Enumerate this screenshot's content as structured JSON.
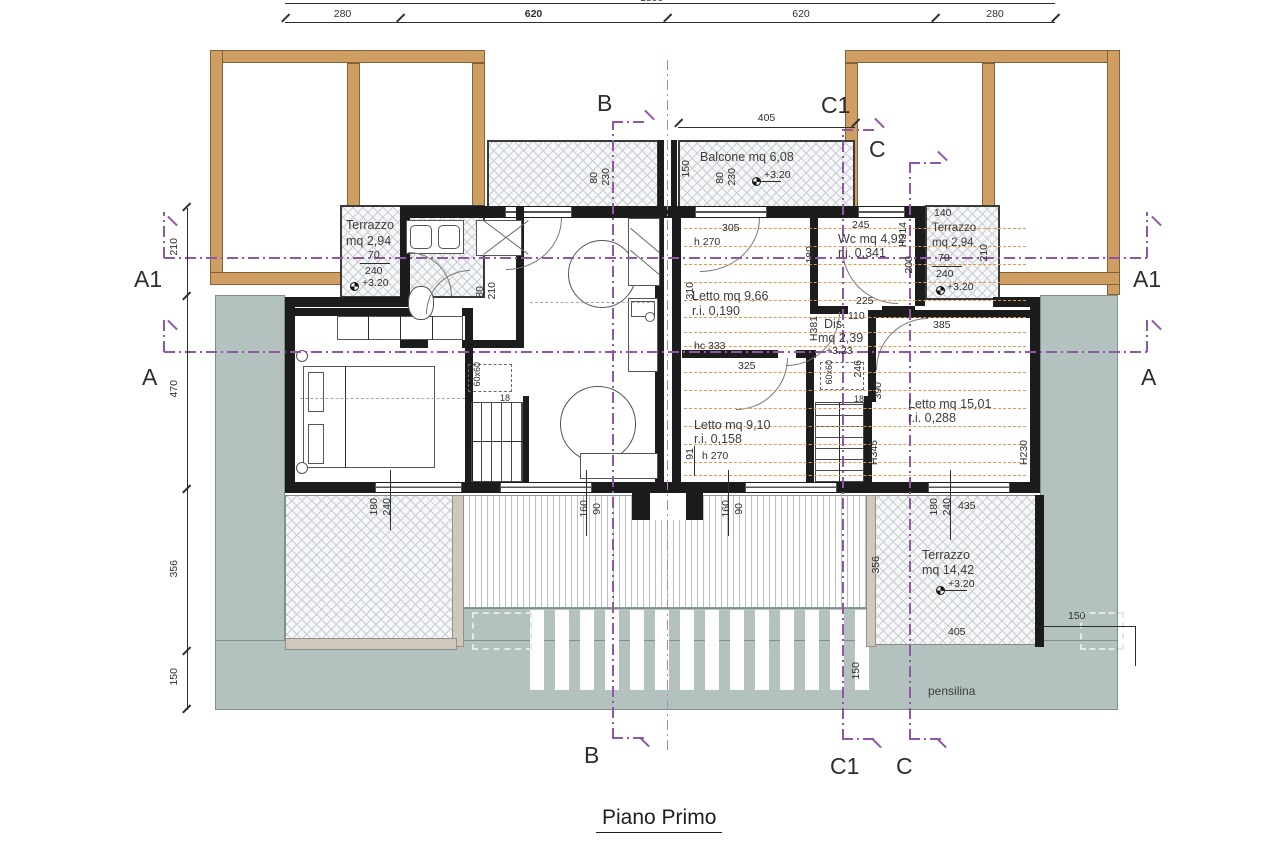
{
  "colors": {
    "wood": "#cf9e63",
    "canopy_gray": "#b4c2bf",
    "section_purple": "#9256a8",
    "roof_slope_orange": "#e2994e",
    "wall_black": "#1c1c1c"
  },
  "title": "Piano Primo",
  "dims": {
    "total": "1800",
    "top": [
      "280",
      "620",
      "620",
      "280"
    ],
    "left": [
      "210",
      "470",
      "356",
      "150"
    ],
    "right150": "150"
  },
  "sections": {
    "a1": "A1",
    "a": "A",
    "b": "B",
    "c1": "C1",
    "c": "C"
  },
  "rooms": {
    "terrazzo_left": {
      "name": "Terrazzo",
      "area": "mq 2,94",
      "win_w": "70",
      "win_h": "240",
      "level": "+3.20"
    },
    "terrazzo_right": {
      "name": "Terrazzo",
      "area": "mq 2,94",
      "win_w": "70",
      "win_h": "240",
      "level": "+3.20",
      "d140": "140",
      "d210": "210",
      "d200": "200",
      "h": "H314"
    },
    "balcone": {
      "name": "Balcone mq 6,08",
      "level": "+3.20",
      "d405": "405",
      "d150": "150",
      "w80": "80",
      "w230": "230"
    },
    "letto1": {
      "name": "Letto mq 9,66",
      "ri": "r.i. 0,190",
      "d305": "305",
      "h270": "h 270",
      "d310": "310",
      "hc": "hc 333",
      "d325": "325"
    },
    "wc": {
      "name": "Wc mq 4,92",
      "ri": "r.i. 0,341",
      "d245": "245",
      "d225": "225",
      "d110": "110",
      "d180": "180"
    },
    "dis": {
      "name": "Dis.",
      "area": "mq 2,39",
      "level": "+3.23",
      "h": "H381",
      "d246": "246",
      "sq": "60x60",
      "d18": "18"
    },
    "letto2": {
      "name": "Letto mq 9,10",
      "ri": "r.i. 0,158",
      "h270": "h 270",
      "d91": "91"
    },
    "letto3": {
      "name": "Letto mq 15,01",
      "ri": "r.i. 0,288",
      "h1": "H345",
      "h2": "H230",
      "d390": "390",
      "d385": "385",
      "d435": "435"
    },
    "terrazzo_big": {
      "name": "Terrazzo",
      "area": "mq 14,42",
      "level": "+3.20",
      "d405": "405",
      "d356": "356",
      "d150": "150"
    },
    "pensilina": "pensilina",
    "left_unit": {
      "sq": "60x60",
      "d18": "18",
      "door_w": "80",
      "door_h": "210"
    },
    "windows": {
      "w180": "180",
      "w240": "240",
      "w160": "160",
      "w90": "90"
    }
  }
}
